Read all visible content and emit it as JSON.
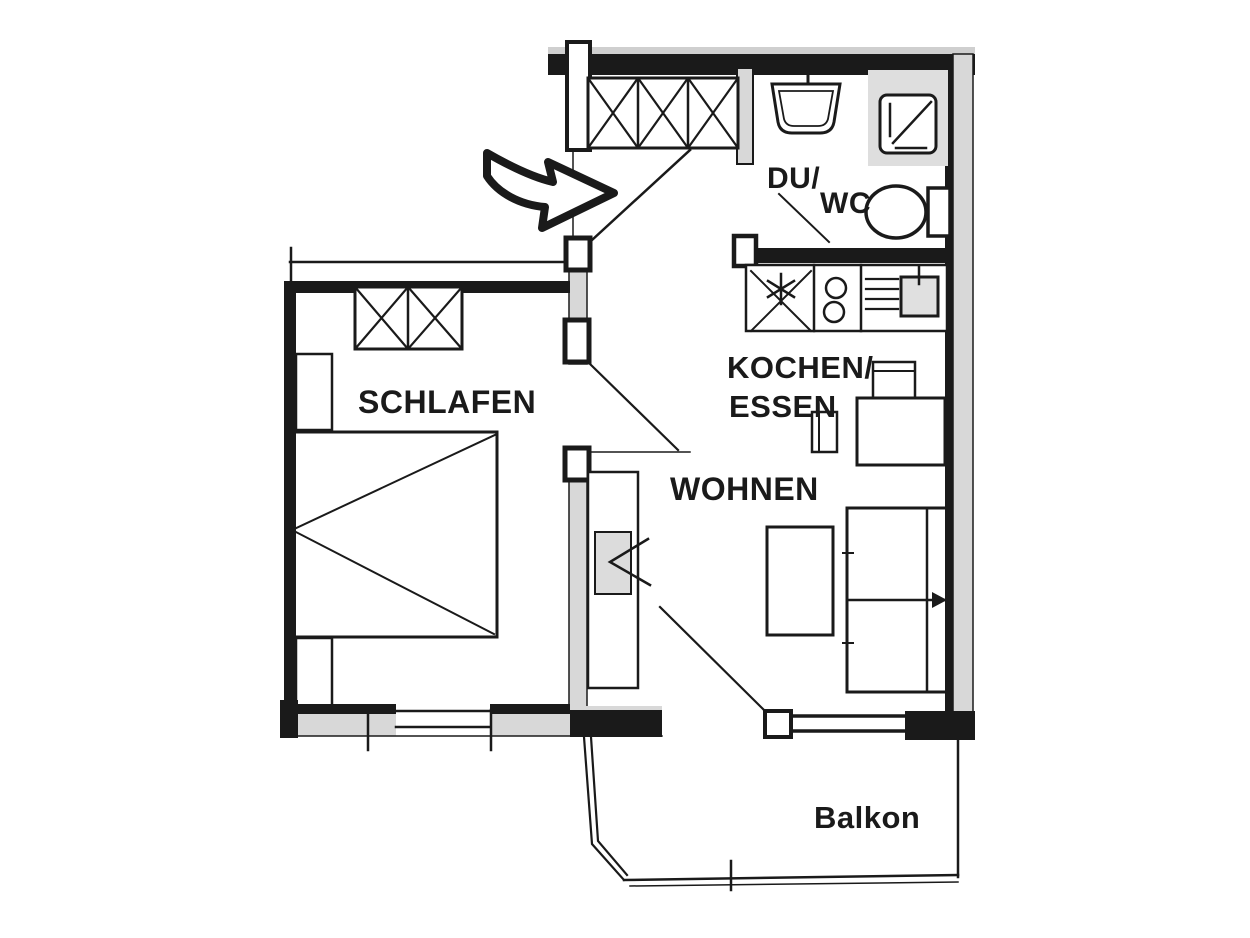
{
  "meta": {
    "type": "apartment-floor-plan",
    "language": "de"
  },
  "colors": {
    "ink": "#1a1a1a",
    "wall_fill": "#d8d8d8",
    "fixture_fill": "#e0e0e0",
    "tv_fill": "#dcdcdc",
    "background": "#ffffff"
  },
  "labels": {
    "bedroom": "SCHLAFEN",
    "living": "WOHNEN",
    "kitchen_line1": "KOCHEN/",
    "kitchen_line2": "ESSEN",
    "bath_line1": "DU/",
    "bath_line2": "WC",
    "balcony": "Balkon"
  },
  "symbols": {
    "entrance_arrow": "curved-arrow-right",
    "wardrobe": "crossed-box-closet",
    "bed": "double-bed-open-v",
    "sofa": "two-seat-sofa-with-arrow",
    "coffee_table": "rectangle-table",
    "dining_table": "table-with-two-chairs",
    "tv_unit": "tv-cabinet-with-chevron",
    "washbasin": "bathroom-sink",
    "shower": "shower-tray-with-drain",
    "toilet": "wc-with-cistern",
    "hob": "two-burner-cooktop",
    "kitchen_sink": "sink-with-drainer-and-star",
    "window": "double-line-window",
    "door": "door-swing-line"
  }
}
